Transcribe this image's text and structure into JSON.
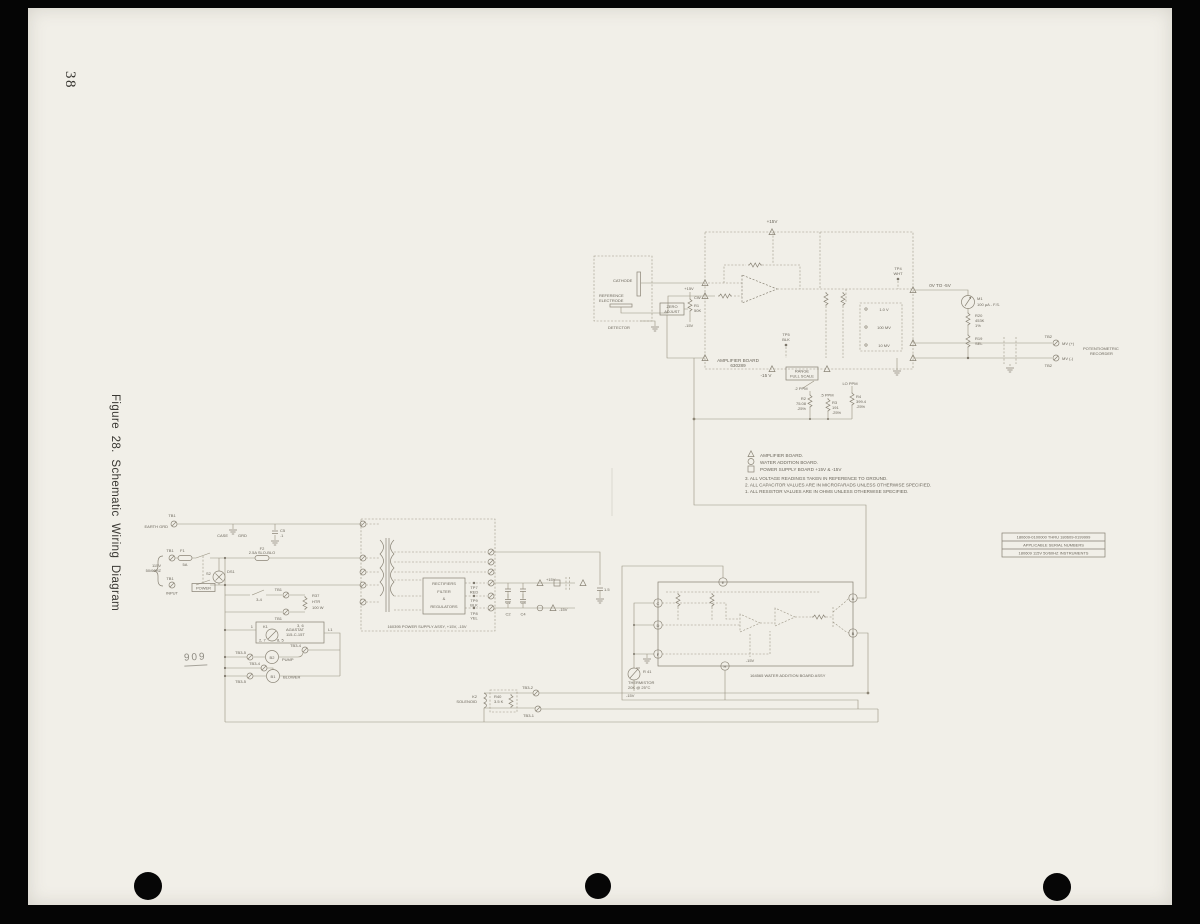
{
  "page": {
    "num": "38",
    "caption": "Figure 28.  Schematic Wiring Diagram",
    "mark": "909"
  },
  "serial": {
    "l1": "180609-0100000 THRU 180609-0199999",
    "l2": "APPLICABLE SERIAL NUMBERS",
    "l3": "180609 115V 50/60HZ INSTRUMENTS"
  },
  "notes": {
    "leg1": "AMPLIFIER BOARD.",
    "leg2": "WATER ADDITION BOARD.",
    "leg3": "POWER SUPPLY BOARD +15V & -15V",
    "n3": "3. ALL VOLTAGE READINGS TAKEN IN REFERENCE TO GROUND.",
    "n2": "2. ALL CAPACITOR VALUES ARE IN MICROFARADS UNLESS OTHERWISE SPECIFIED.",
    "n1": "1. ALL RESISTOR VALUES ARE IN OHMS UNLESS OTHERWISE SPECIFIED."
  },
  "amp": {
    "plus15": "+15V",
    "cathode": "CATHODE",
    "ref1": "REFERENCE",
    "ref2": "ELECTRODE",
    "detector": "DETECTOR",
    "zero1": "ZERO",
    "zero2": "ADJUST",
    "pot_plus": "+15V",
    "pot_cw": "CW",
    "pot_r": "R1",
    "pot_v": "50K",
    "pot_minus": "-15V",
    "board1": "AMPLIFIER BOARD",
    "board2": "630289",
    "tp5a": "TP5",
    "tp5b": "BLK",
    "tp4a": "TP4",
    "tp4b": "WHT",
    "neg15": "-15 V",
    "range1": "RANGE",
    "range2": "FULL SCALE",
    "ppm2": ".2 PPM",
    "ppm5": ".5 PPM",
    "ppmlo": "LO PPM",
    "r2a": "R2",
    "r2b": "75.08",
    "r2c": ".25%",
    "r3a": "R3",
    "r3b": "191",
    "r3c": ".25%",
    "r4a": "R4",
    "r4b": "399.4",
    "r4c": ".25%",
    "tap1": "1.0 V",
    "tap2": "100 MV",
    "tap3": "10 MV",
    "ovto": "0V TO -5V",
    "m1a": "M1",
    "m1b": "100 µA - F.S.",
    "r20a": "R20",
    "r20b": "453K",
    "r20c": "1%",
    "r19a": "R19",
    "r19b": "SEL",
    "tb2a": "TB2",
    "tb2b": "TB2",
    "mvp": "MV (+)",
    "mvm": "MV (-)",
    "rec1": "POTENTIOMETRIC",
    "rec2": "RECORDER"
  },
  "ps": {
    "tb1_grd": "TB1",
    "earth": "EARTH GRD",
    "case": "CASE",
    "grd": "GRD",
    "c5a": "C5",
    "c5b": ".1",
    "in1": "115V",
    "in2": "50/60HZ",
    "in3": "INPUT",
    "tb1a": "TB1",
    "f1": "F1",
    "f1v": "5A",
    "tb1b": "TB1",
    "s2": "S2",
    "power": "POWER",
    "ds1": "DS1",
    "f2a": "F2",
    "f2b": "2.5A SLO-BLO",
    "sw34": "3-4",
    "tb1c": "TB1",
    "tb1d": "TB1",
    "r37a": "R37",
    "r37b": "HTR",
    "r37c": "100 W",
    "k1": "K1",
    "aga1": "AGASTAT",
    "aga2": "115-C-15T",
    "p1": "1",
    "p36": "3, 6",
    "p27": "2, 7",
    "p85": "8, 5",
    "l1": "L1",
    "tb35a": "TB3-5",
    "tb34a": "TB3-4",
    "b2": "B2",
    "pump": "PUMP",
    "tb34b": "TB3-4",
    "tb35b": "TB3-5",
    "b1": "B1",
    "blower": "BLOWER",
    "k2a": "K2",
    "k2b": "SOLENOID",
    "r40a": "R40",
    "r40b": "3.5 K",
    "tb32": "TB3-2",
    "tb31": "TB3-1",
    "box1": "RECTIFIERS",
    "box2": "FILTER",
    "box3": "&",
    "box4": "REGULATORS",
    "tp7a": "TP7",
    "tp7b": "RED",
    "tp9a": "TP9",
    "tp9b": "BLK",
    "tp8a": "TP8",
    "tp8b": "YEL",
    "assy": "160395 POWER SUPPLY ASSY, +15V, -15V",
    "c1": "C1",
    "c2": "C2",
    "c3": "C3",
    "c4": "C4",
    "p15": "+15V",
    "m15": "-15V",
    "c6": "1.5"
  },
  "wa": {
    "pe": "E",
    "pc": "C",
    "pd": "D",
    "pf": "F",
    "ph": "H",
    "pa": "A",
    "pb": "B",
    "r41": "R 41",
    "th1": "THERMISTOR",
    "th2": "20K @ 25°C",
    "m15a": "-15V",
    "m15b": "-15V",
    "assy": "164565 WATER ADDITION BOARD ASSY"
  }
}
